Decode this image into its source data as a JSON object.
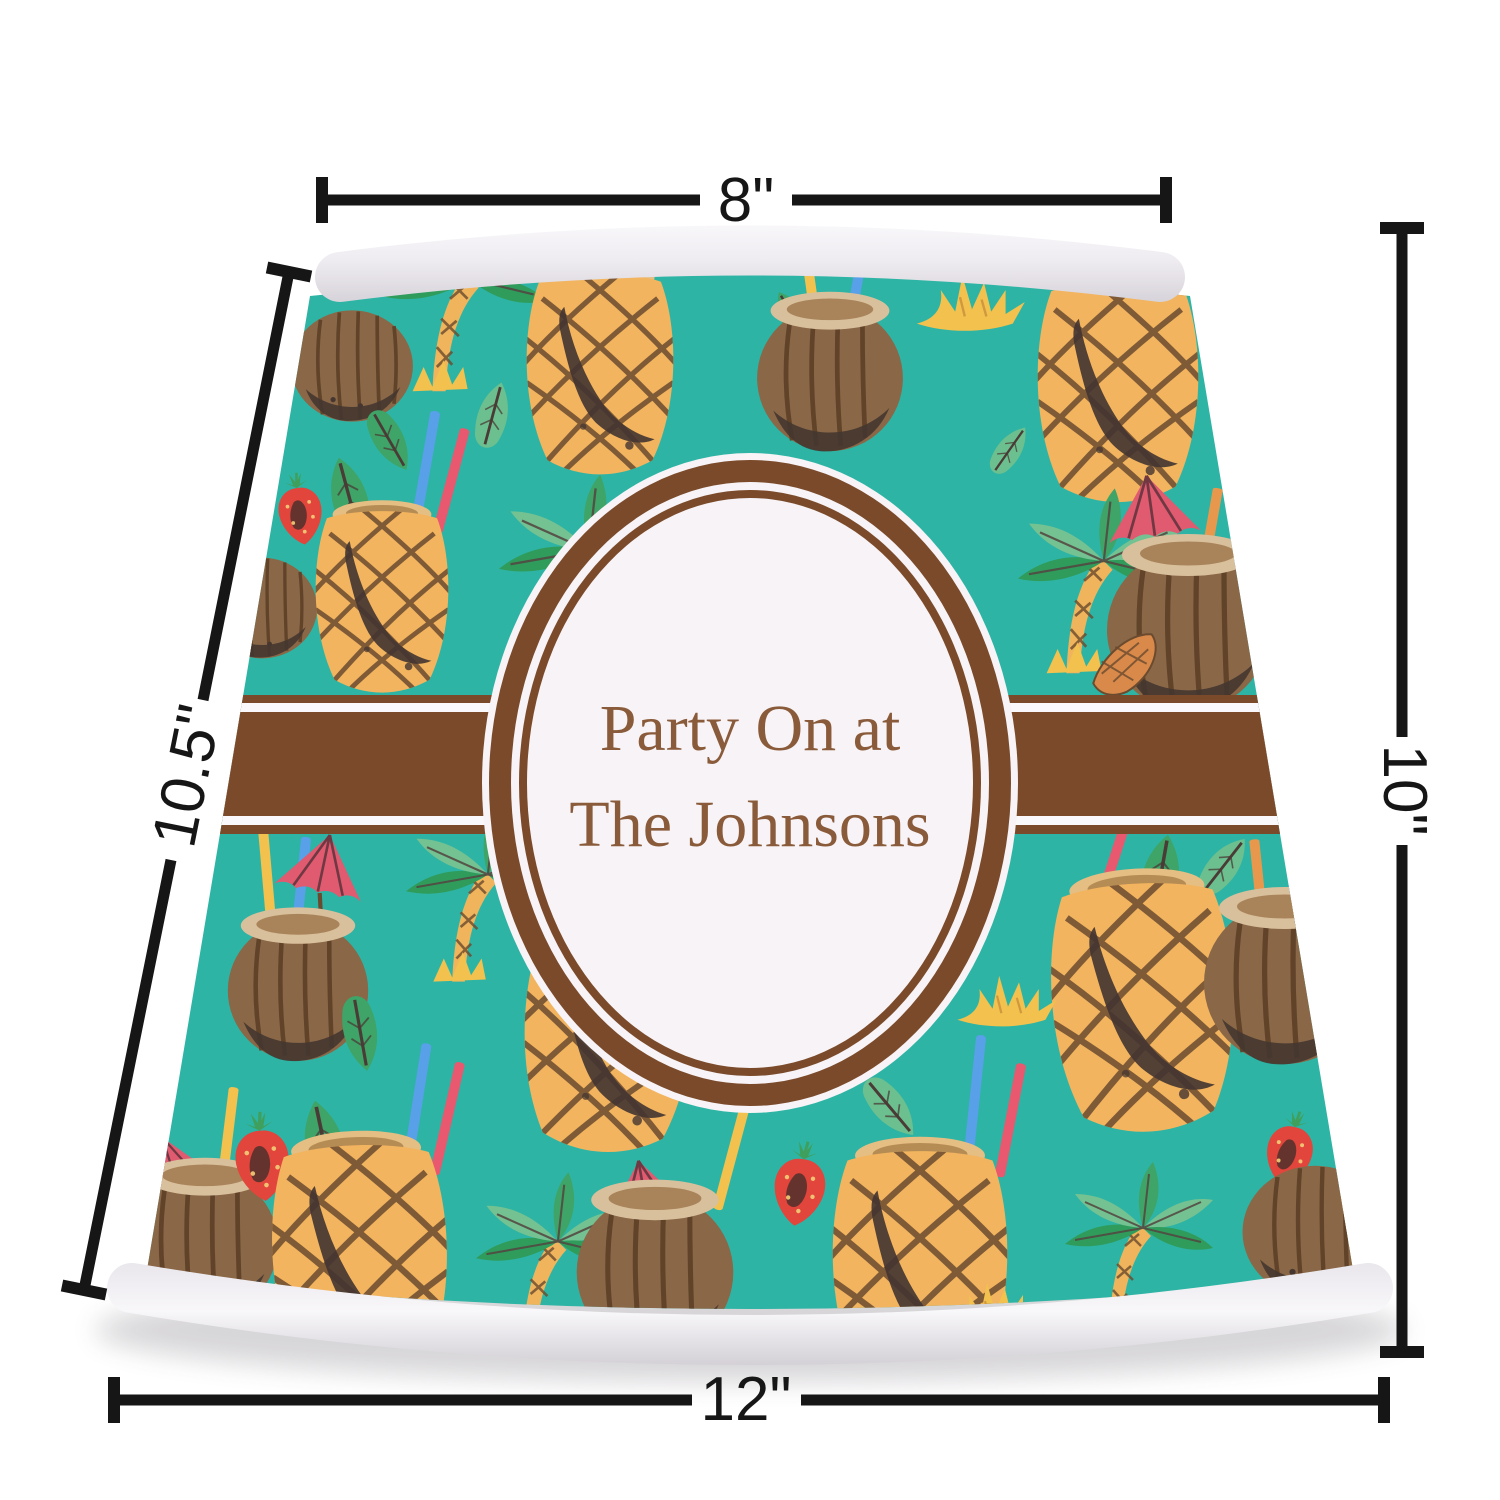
{
  "product_preview": {
    "type": "lamp shade preview",
    "personalization": {
      "line1": "Party On at",
      "line2": "The Johnsons"
    },
    "pattern_theme": "pineapple-coconut-tropical-drinks",
    "colors": {
      "pattern_teal": "#2EB4A4",
      "band_brown": "#7A4A2A",
      "oval_fill": "#F7F3F6",
      "text_brown": "#8A5B3A",
      "trim_white": "#F2F0F3",
      "pineapple": "#F2B45E",
      "coconut": "#8A6747",
      "leaf_green": "#3EA467",
      "strawberry_red": "#E2453C",
      "umbrella_pink": "#E05A70"
    }
  },
  "dimensions": {
    "top_width": {
      "label": "8\""
    },
    "left_slant_height": {
      "label": "10.5\""
    },
    "right_height": {
      "label": "10\""
    },
    "bottom_width": {
      "label": "12\""
    }
  }
}
